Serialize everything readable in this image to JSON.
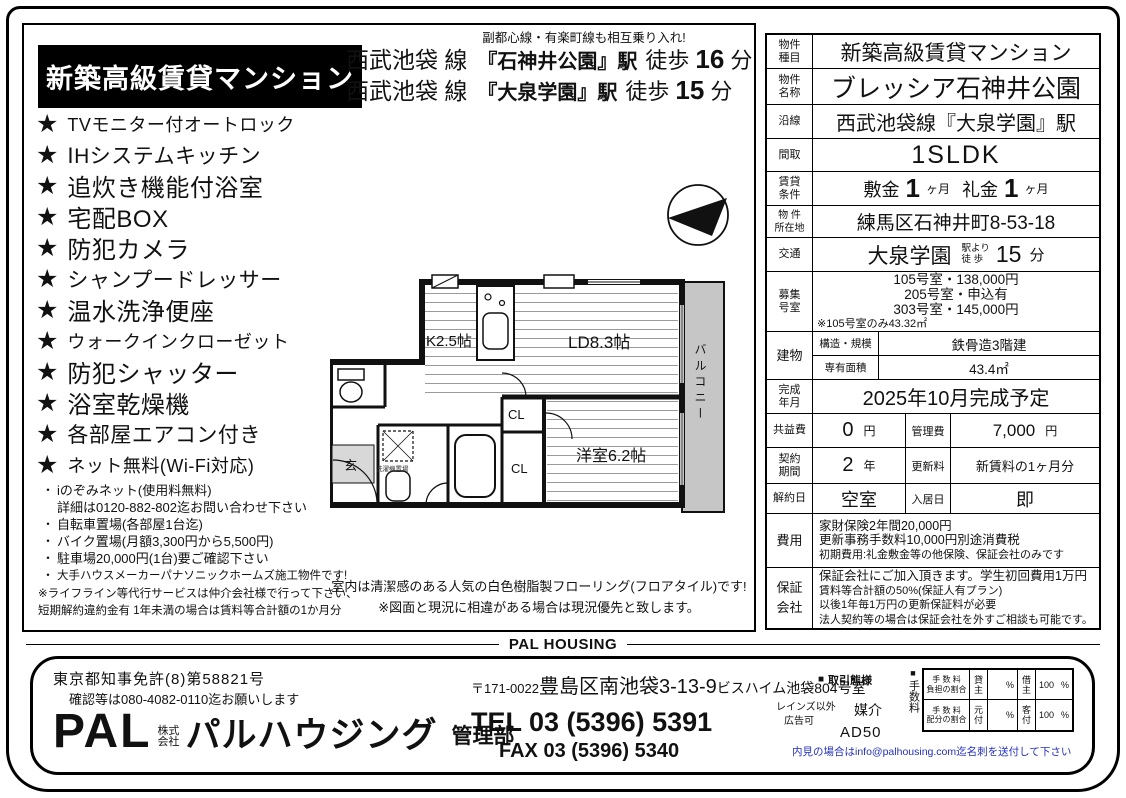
{
  "icons": {
    "star": "★",
    "square": "■",
    "dot": "・"
  },
  "header": {
    "top_note": "副都心線・有楽町線も相互乗り入れ!",
    "badge": "新築高級賃貸マンション",
    "access": [
      {
        "line": "西武池袋 線",
        "station": "『石神井公園』駅",
        "walk": "徒歩",
        "minutes": "16",
        "unit": "分"
      },
      {
        "line": "西武池袋 線",
        "station": "『大泉学園』駅",
        "walk": "徒歩",
        "minutes": "15",
        "unit": "分"
      }
    ]
  },
  "features": {
    "stars": [
      "TVモニター付オートロック",
      "ⅠHシステムキッチン",
      "追炊き機能付浴室",
      "宅配BOX",
      "防犯カメラ",
      "シャンプードレッサー",
      "温水洗浄便座",
      "ウォークインクローゼット",
      "防犯シャッター",
      "浴室乾燥機",
      "各部屋エアコン付き",
      "ネット無料(Wi-Fi対応)"
    ],
    "bullets": [
      "iのぞみネット(使用料無料)",
      "自転車置場(各部屋1台迄)",
      "バイク置場(月額3,300円から5,500円)",
      "駐車場20,000円(1台)要ご確認下さい",
      "大手ハウスメーカーパナソニックホームズ施工物件です!"
    ],
    "bullet_cont": "詳細は0120-882-802迄お問い合わせ下さい",
    "note1": "※ライフライン等代行サービスは仲介会社様で行って下さい、",
    "note2": "短期解約違約金有 1年未満の場合は賃料等合計額の1か月分"
  },
  "floorplan": {
    "kitchen": "K2.5帖",
    "living": "LD8.3帖",
    "bedroom": "洋室6.2帖",
    "closet1": "CL",
    "closet2": "CL",
    "entrance": "玄",
    "balcony": "バルコニー",
    "washer": "洗濯機置場",
    "caption1": "室内は清潔感のある人気の白色樹脂製フローリング(フロアタイル)です!",
    "caption2": "※図面と現況に相違がある場合は現況優先と致します。"
  },
  "spec": {
    "r1": {
      "l1": "物件",
      "l2": "種目",
      "value": "新築高級賃貸マンション"
    },
    "r2": {
      "l1": "物件",
      "l2": "名称",
      "value": "ブレッシア石神井公園"
    },
    "r3": {
      "l1": "沿線",
      "value": "西武池袋線『大泉学園』駅"
    },
    "r4": {
      "l1": "間取",
      "value": "1SLDK"
    },
    "r5": {
      "l1": "賃貸",
      "l2": "条件",
      "k1": "敷金",
      "v1": "1",
      "u1": "ヶ月",
      "k2": "礼金",
      "v2": "1",
      "u2": "ヶ月"
    },
    "r6": {
      "l1": "物 件",
      "l2": "所在地",
      "value": "練馬区石神井町8-53-18"
    },
    "r7": {
      "l1": "交通",
      "station": "大泉学園",
      "n1": "駅より",
      "n2": "徒 歩",
      "min": "15",
      "unit": "分"
    },
    "r8": {
      "l1": "募集",
      "l2": "号室",
      "line1": "105号室・138,000円",
      "line2": "205号室・申込有",
      "line3": "303号室・145,000円",
      "line4": "※105号室のみ43.32㎡"
    },
    "r9": {
      "l1": "建物",
      "h1": "構造・規模",
      "v1": "鉄骨造3階建",
      "h2": "専有面積",
      "v2": "43.4㎡"
    },
    "r10": {
      "l1": "完成",
      "l2": "年月",
      "value": "2025年10月完成予定"
    },
    "r11": {
      "k1": "共益費",
      "v1": "0",
      "u1": "円",
      "k2": "管理費",
      "v2": "7,000",
      "u2": "円"
    },
    "r12": {
      "l1": "契約",
      "l2": "期間",
      "v1": "2",
      "u1": "年",
      "k2": "更新料",
      "v2": "新賃料の1ヶ月分"
    },
    "r13": {
      "k1": "解約日",
      "v1": "空室",
      "k2": "入居日",
      "v2": "即"
    },
    "r14": {
      "l1": "費用",
      "line1": "家財保険2年間20,000円",
      "line2": "更新事務手数料10,000円別途消費税",
      "line3": "初期費用:礼金敷金等の他保険、保証会社のみです"
    },
    "r15": {
      "l1": "保証",
      "l2": "会社",
      "line1": "保証会社にご加入頂きます。学生初回費用1万円",
      "line2": "賃料等合計額の50%(保証人有プラン)",
      "line3": "以後1年毎1万円の更新保証料が必要",
      "line4": "法人契約等の場合は保証会社を外すご相談も可能です。"
    }
  },
  "footer": {
    "brand_divider": "PAL HOUSING",
    "license1": "東京都知事免許(8)第58821号",
    "license2": "確認等は080-4082-0110迄お願いします",
    "logo_en": "PAL",
    "corp1": "株式",
    "corp2": "会社",
    "logo_jp": "パルハウジング",
    "dept": "管理部",
    "postal": "〒171-0022",
    "addr_main": "豊島区南池袋3-13-9",
    "addr_sub": "ビスハイム池袋804号室",
    "tel": "TEL 03 (5396) 5391",
    "fax": "FAX 03 (5396) 5340",
    "trade_type_label": "取引態様",
    "trade_type": "媒介",
    "reins": "レインズ以外",
    "ad_ok": "広告可",
    "ad_code": "AD50",
    "fee_side_label": "手数料",
    "fee": {
      "r1h1": "手 数 料",
      "r1h2": "負担の割合",
      "r1p1": "貸主",
      "r1u1": "%",
      "r1p2": "借主",
      "r1v2": "100",
      "r1u2": "%",
      "r2h1": "手 数 料",
      "r2h2": "配分の割合",
      "r2p1": "元付",
      "r2u1": "%",
      "r2p2": "客付",
      "r2v2": "100",
      "r2u2": "%"
    },
    "visit_note": "内見の場合はinfo@palhousing.com迄名刺を送付して下さい"
  }
}
